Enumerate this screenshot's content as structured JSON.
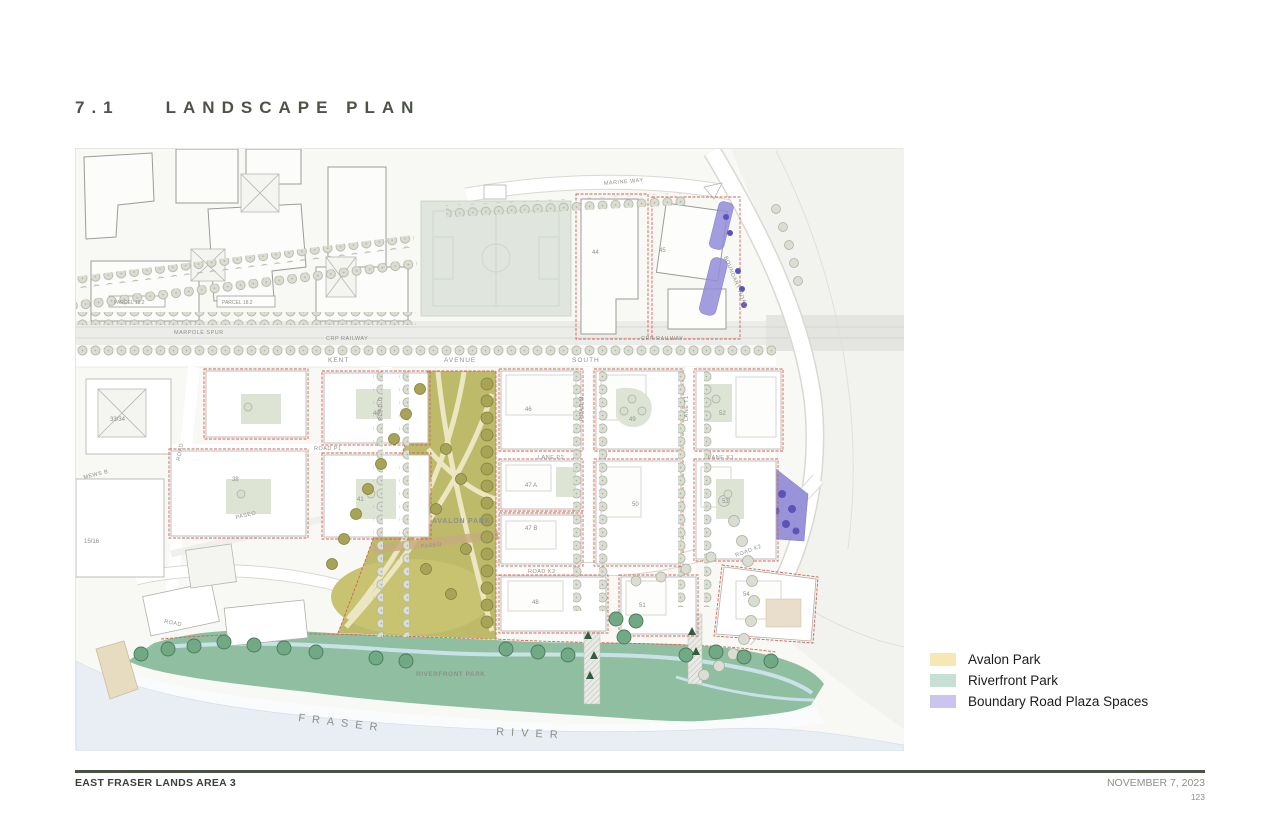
{
  "page": {
    "section_number": "7.1",
    "title": "LANDSCAPE PLAN"
  },
  "legend": {
    "items": [
      {
        "label": "Avalon Park",
        "color": "#F7E7B5"
      },
      {
        "label": "Riverfront Park",
        "color": "#C6E0D6"
      },
      {
        "label": "Boundary Road Plaza Spaces",
        "color": "#C9C5EF"
      }
    ]
  },
  "footer": {
    "project": "EAST FRASER LANDS AREA 3",
    "date": "NOVEMBER 7, 2023",
    "page_number": "123"
  },
  "map": {
    "colors": {
      "avalon_park": "#BDBA6A",
      "riverfront_park": "#8FBFA0",
      "plaza": "#8F89D6",
      "water": "#E9EEF5"
    },
    "roads": {
      "marine_way": "MARINE WAY",
      "boundary_road": "BOUNDARY ROAD",
      "marpole_spur": "MARPOLE SPUR",
      "crp_railway": "CRP RAILWAY",
      "kent": "KENT",
      "avenue": "AVENUE",
      "south": "SOUTH",
      "road_d": "ROAD D",
      "road_m": "ROAD M",
      "lane_t1": "LANE T1",
      "lane_p2": "LANE P2",
      "lane_k1": "LANE K1",
      "road_p1": "ROAD P1",
      "road_k2": "ROAD K2",
      "paseo": "PASEO",
      "mews_b": "MEWS B",
      "road": "ROAD"
    },
    "parks": {
      "avalon": "AVALON PARK",
      "riverfront": "RIVERFRONT PARK"
    },
    "water": {
      "fraser": "FRASER",
      "river": "RIVER"
    },
    "parcels": {
      "p18_2": "PARCEL 18.2",
      "p33_34": "33/34",
      "p15_16": "15/16",
      "p38": "38",
      "p40": "40",
      "p41": "41",
      "p44": "44",
      "p45": "45",
      "p46": "46",
      "p47a": "47 A",
      "p47b": "47 B",
      "p48": "48",
      "p49": "49",
      "p50": "50",
      "p51": "51",
      "p52": "52",
      "p53": "53",
      "p54": "54"
    }
  }
}
